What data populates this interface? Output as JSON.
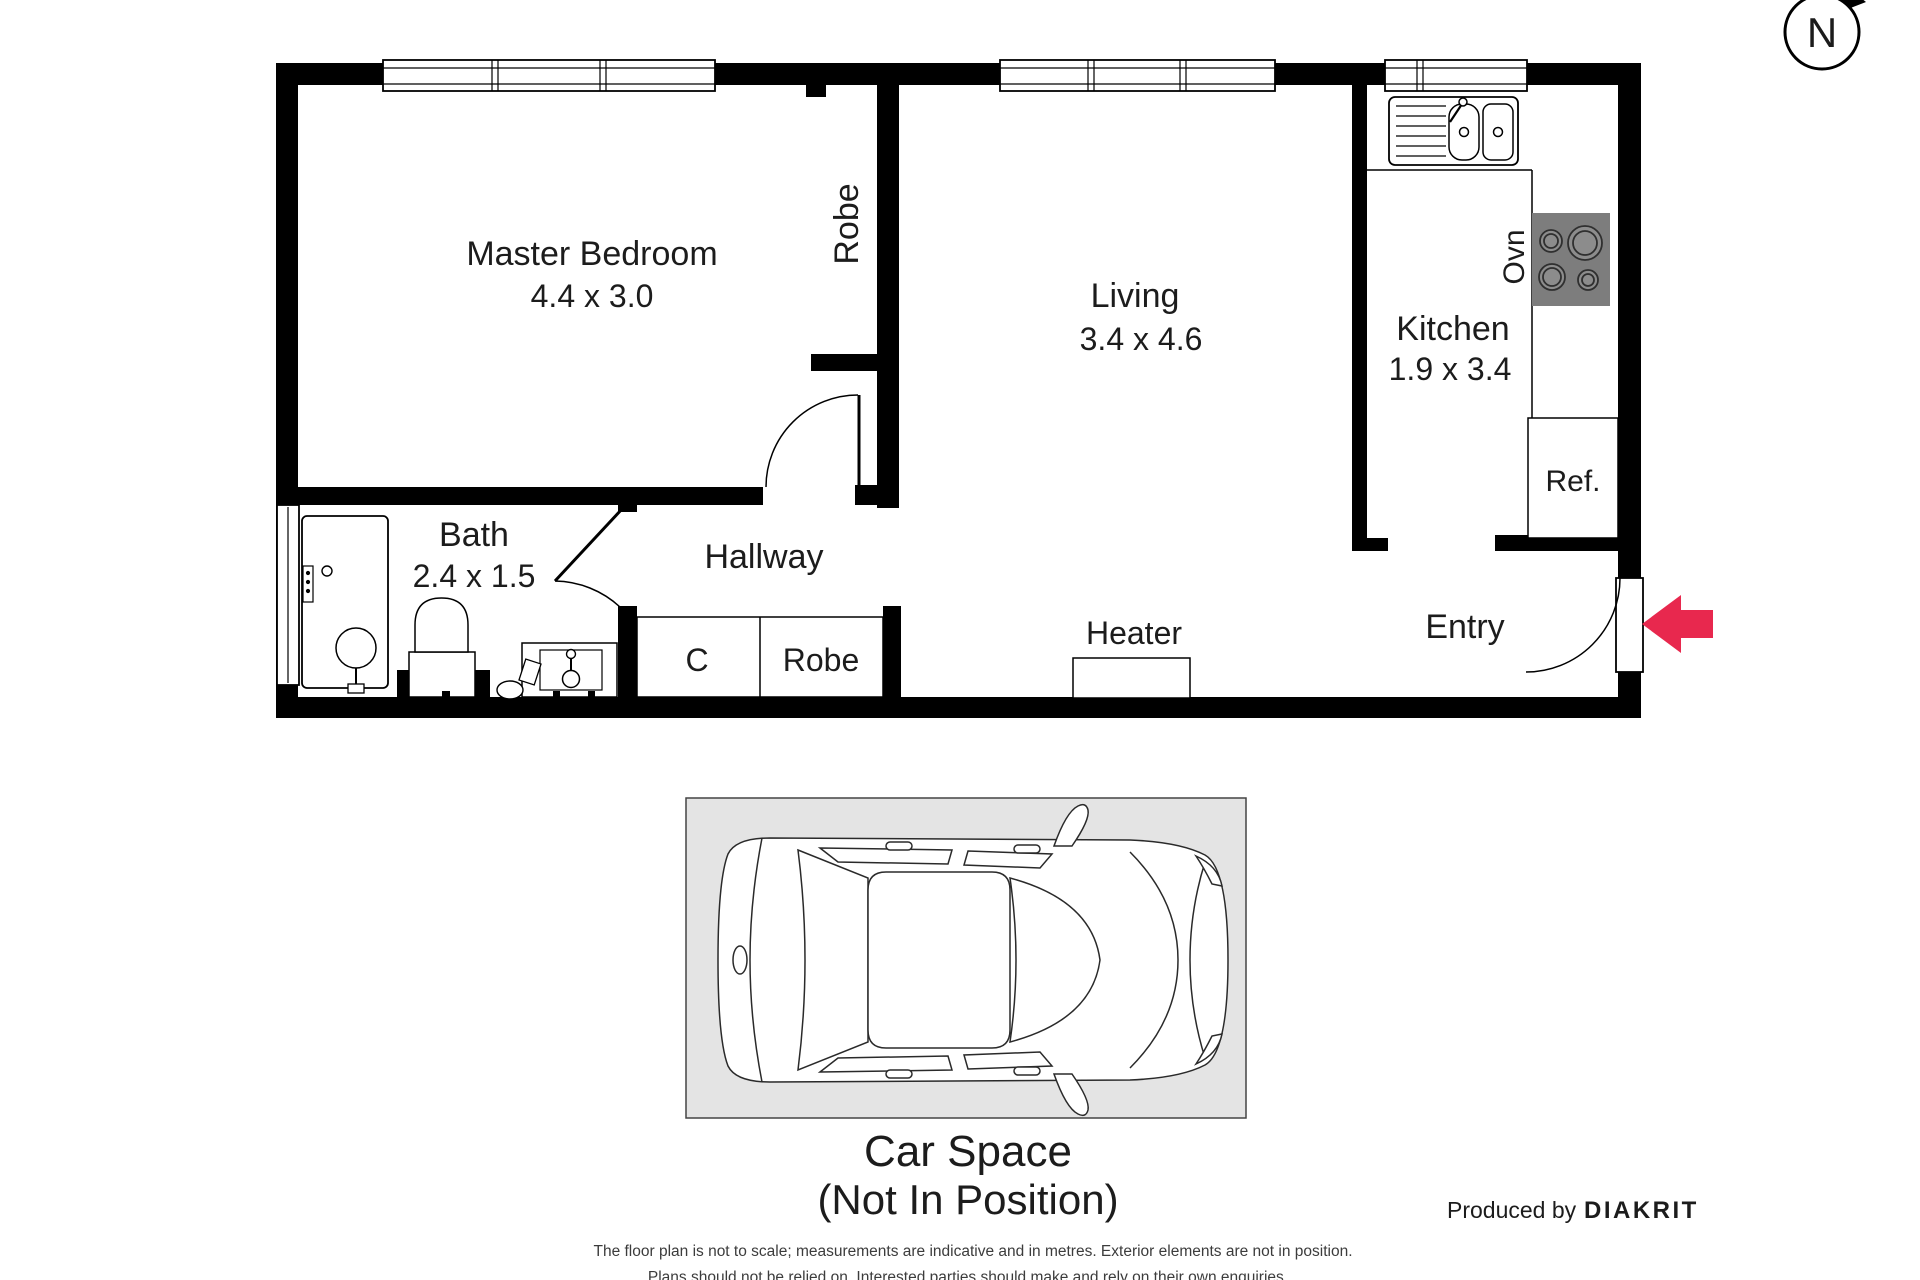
{
  "compass": {
    "label": "N"
  },
  "rooms": {
    "master_bedroom": {
      "name": "Master Bedroom",
      "dims": "4.4 x 3.0"
    },
    "robe_bedroom": {
      "name": "Robe"
    },
    "living": {
      "name": "Living",
      "dims": "3.4 x 4.6"
    },
    "kitchen": {
      "name": "Kitchen",
      "dims": "1.9 x 3.4"
    },
    "oven": {
      "name": "Ovn"
    },
    "fridge": {
      "name": "Ref."
    },
    "bath": {
      "name": "Bath",
      "dims": "2.4 x 1.5"
    },
    "hallway": {
      "name": "Hallway"
    },
    "closet": {
      "name": "C"
    },
    "robe_hall": {
      "name": "Robe"
    },
    "heater": {
      "name": "Heater"
    },
    "entry": {
      "name": "Entry"
    }
  },
  "car_space": {
    "title": "Car Space",
    "subtitle": "(Not In Position)"
  },
  "footer": {
    "disclaimer_line1": "The floor plan is not to scale; measurements are indicative and in metres. Exterior elements are not in position.",
    "disclaimer_line2": "Plans should not be relied on. Interested parties should make and rely on their own enquiries.",
    "produced_by": "Produced by",
    "brand": "DIAKRIT"
  },
  "colors": {
    "wall": "#000000",
    "entry_arrow": "#e8284e",
    "car_pad": "#e4e4e4",
    "stove": "#7d7d7d",
    "stove_burner": "#8c8c8c"
  }
}
